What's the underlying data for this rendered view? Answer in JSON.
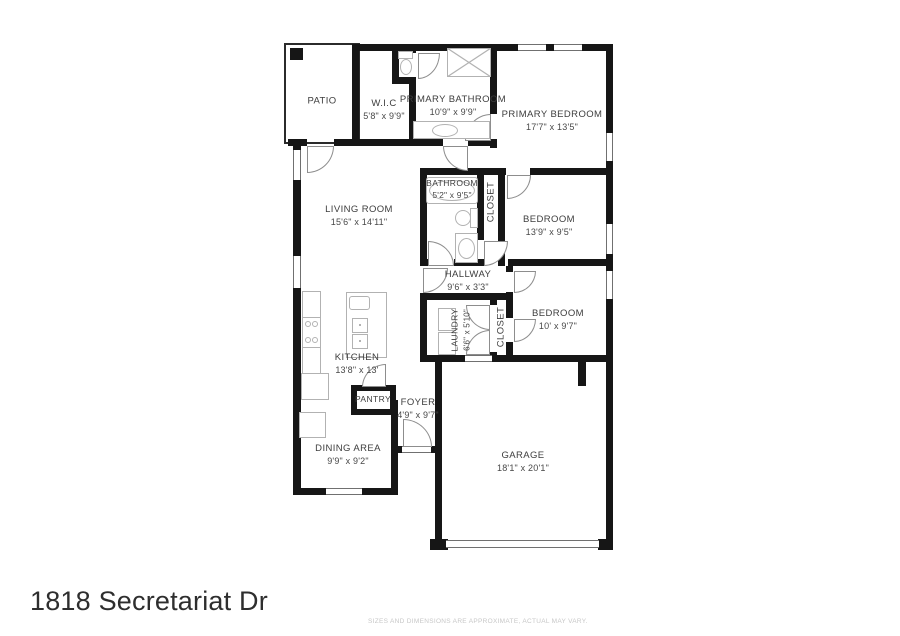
{
  "address": "1818 Secretariat Dr",
  "disclaimer": "SIZES AND DIMENSIONS ARE APPROXIMATE, ACTUAL MAY VARY.",
  "colors": {
    "wall": "#161616",
    "label_text": "#3d3d3d",
    "fixture_line": "#b2b2b2",
    "disclaimer_text": "#c7c7c7",
    "background": "#ffffff"
  },
  "rooms": {
    "patio": {
      "label": "PATIO",
      "dims": ""
    },
    "wic": {
      "label": "W.I.C",
      "dims": "5'8\" x 9'9\""
    },
    "primary_bath": {
      "label": "PRIMARY BATHROOM",
      "dims": "10'9\" x 9'9\""
    },
    "primary_bed": {
      "label": "PRIMARY BEDROOM",
      "dims": "17'7\" x 13'5\""
    },
    "living": {
      "label": "LIVING ROOM",
      "dims": "15'6\" x 14'11\""
    },
    "bathroom": {
      "label": "BATHROOM",
      "dims": "5'2\" x 9'5\""
    },
    "closet1": {
      "label": "CLOSET",
      "dims": ""
    },
    "bedroom1": {
      "label": "BEDROOM",
      "dims": "13'9\" x 9'5\""
    },
    "hallway": {
      "label": "HALLWAY",
      "dims": "9'6\" x 3'3\""
    },
    "bedroom2": {
      "label": "BEDROOM",
      "dims": "10' x 9'7\""
    },
    "laundry": {
      "label": "LAUNDRY",
      "dims": "6'6\" x 5'10\""
    },
    "closet2": {
      "label": "CLOSET",
      "dims": ""
    },
    "kitchen": {
      "label": "KITCHEN",
      "dims": "13'8\" x 13'"
    },
    "pantry": {
      "label": "PANTRY",
      "dims": ""
    },
    "foyer": {
      "label": "FOYER",
      "dims": "4'9\" x 9'7\""
    },
    "dining": {
      "label": "DINING AREA",
      "dims": "9'9\" x 9'2\""
    },
    "garage": {
      "label": "GARAGE",
      "dims": "18'1\" x 20'1\""
    }
  }
}
